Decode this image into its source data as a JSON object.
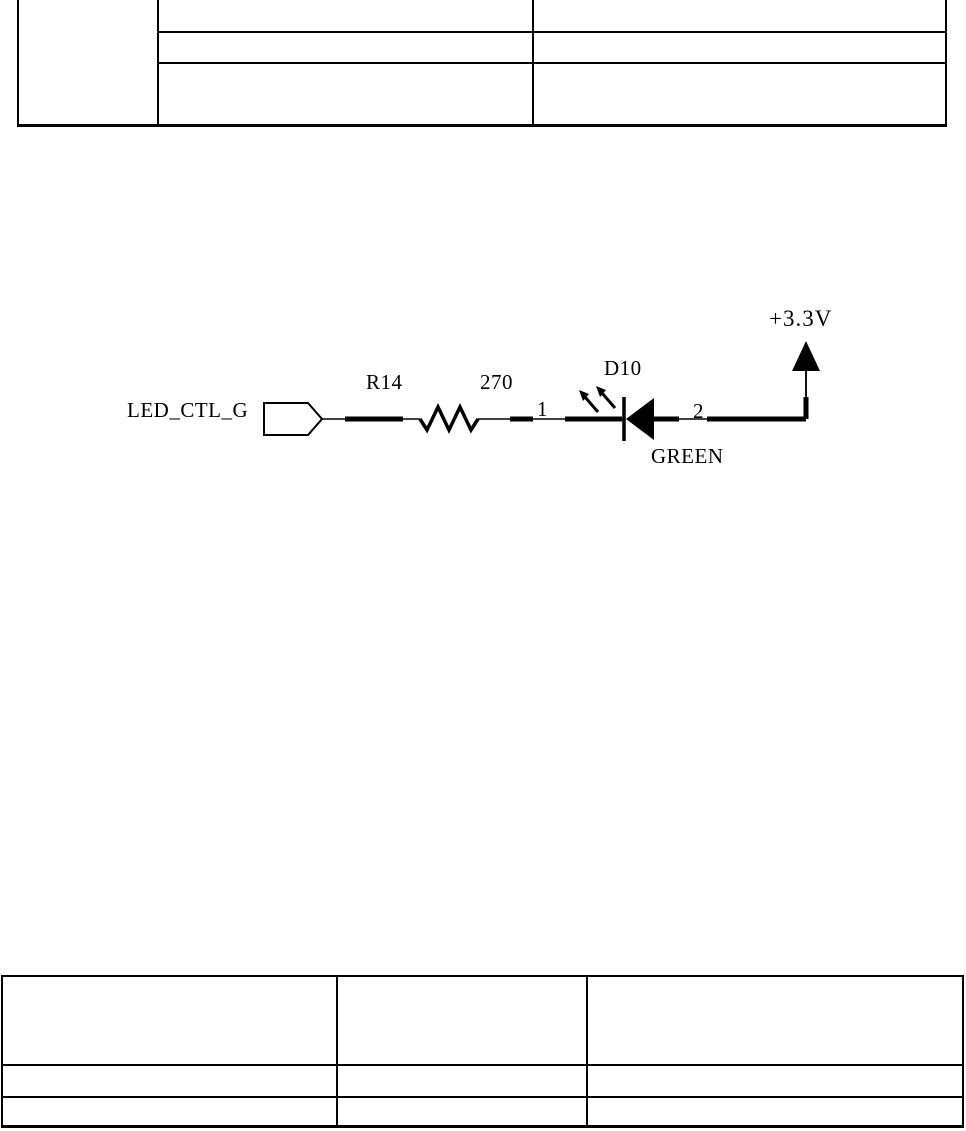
{
  "page": {
    "background": "#ffffff",
    "line_color": "#000000"
  },
  "top_table": {
    "rows": 3,
    "cols": 3,
    "all_cells_empty": true
  },
  "schematic": {
    "net_label": "LED_CTL_G",
    "resistor_ref": "R14",
    "resistor_value": "270",
    "led_ref": "D10",
    "led_color": "GREEN",
    "pin_1": "1",
    "pin_2": "2",
    "power_net": "+3.3V"
  },
  "bottom_table": {
    "rows": 3,
    "cols": 3,
    "all_cells_empty": true
  }
}
